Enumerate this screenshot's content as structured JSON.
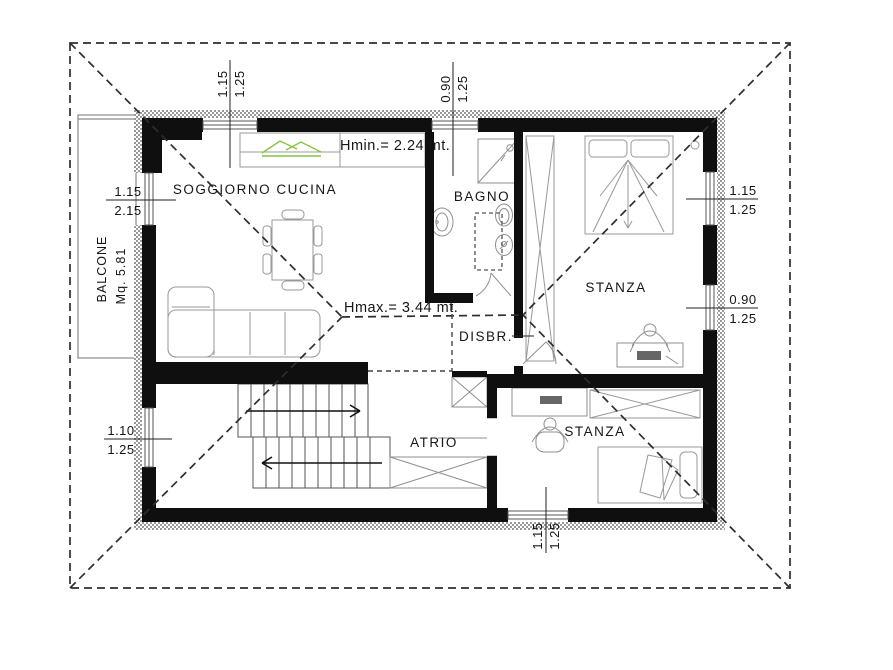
{
  "plan": {
    "rooms": [
      {
        "id": "soggiorno-cucina",
        "label": "SOGGIORNO CUCINA"
      },
      {
        "id": "bagno",
        "label": "BAGNO"
      },
      {
        "id": "stanza-nord",
        "label": "STANZA"
      },
      {
        "id": "disimpegno",
        "label": "DISBR."
      },
      {
        "id": "atrio",
        "label": "ATRIO"
      },
      {
        "id": "stanza-sud",
        "label": "STANZA"
      },
      {
        "id": "balcone",
        "label": "BALCONE",
        "area": "Mq. 5.81"
      }
    ],
    "heights": {
      "hmin": "Hmin.= 2.24 mt.",
      "hmax": "Hmax.= 3.44 mt."
    },
    "windows": [
      {
        "id": "top-soggiorno",
        "width": "1.15",
        "height": "1.25"
      },
      {
        "id": "top-bagno",
        "width": "0.90",
        "height": "1.25"
      },
      {
        "id": "left-balcone-door",
        "width": "1.15",
        "height": "2.15"
      },
      {
        "id": "left-scala",
        "width": "1.10",
        "height": "1.25"
      },
      {
        "id": "right-stanza-nord-1",
        "width": "1.15",
        "height": "1.25"
      },
      {
        "id": "right-stanza-nord-2",
        "width": "0.90",
        "height": "1.25"
      },
      {
        "id": "bottom-stanza-sud",
        "width": "1.15",
        "height": "1.25"
      }
    ],
    "colors": {
      "wall": "#0f0f0f",
      "furniture": "#8f8f8f",
      "roof_dash": "#2e2e2e",
      "kitchen_green": "#86c440",
      "hatch": "#9a9a9a"
    }
  }
}
